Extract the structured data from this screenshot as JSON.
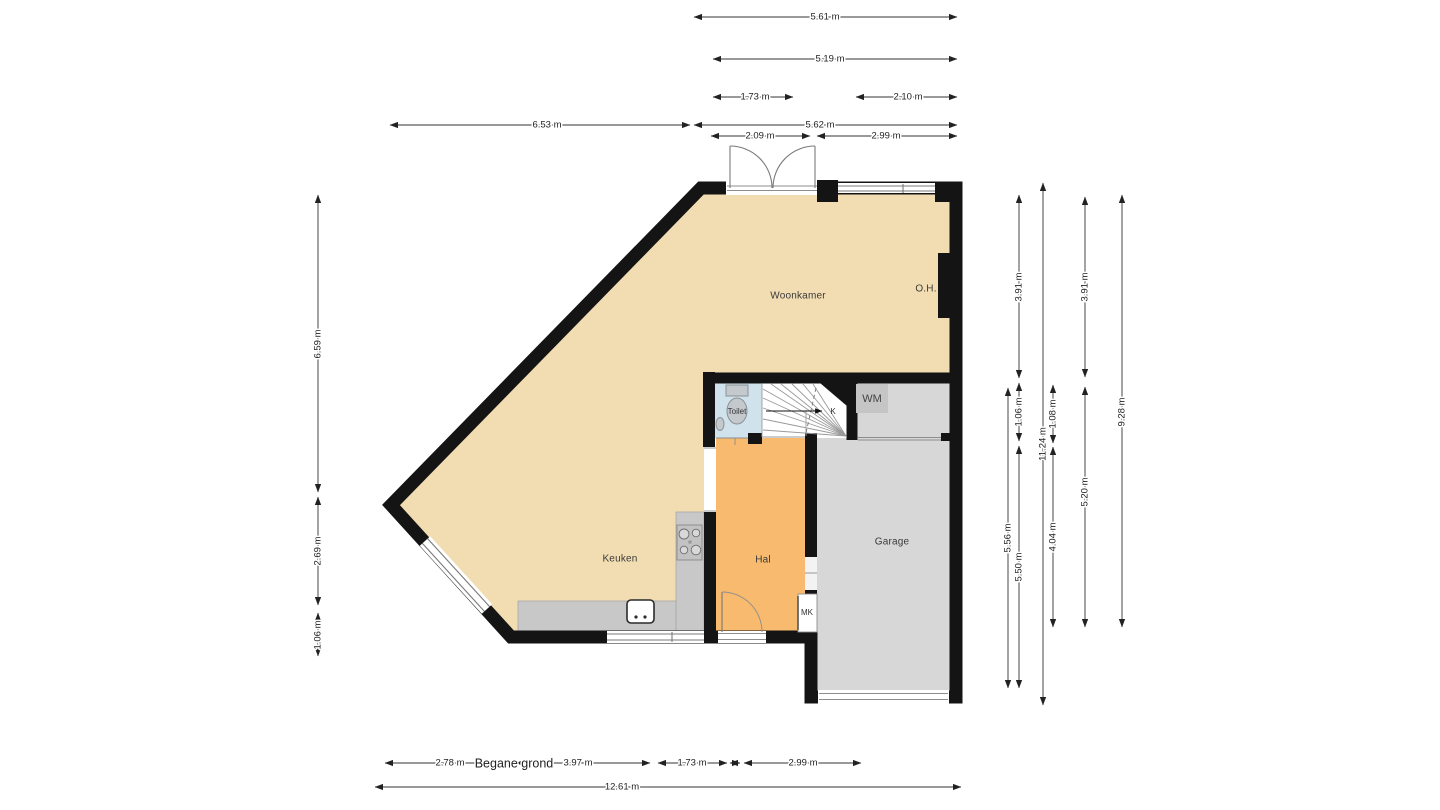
{
  "title": "Begane grond",
  "rooms": {
    "woonkamer": "Woonkamer",
    "keuken": "Keuken",
    "hal": "Hal",
    "garage": "Garage",
    "toilet": "Toilet",
    "stairs": "K",
    "fireplace": "O.H.",
    "washer": "WM",
    "meter_closet": "MK"
  },
  "dimensions": {
    "top": [
      "5.61 m",
      "5.19 m",
      "1.73 m",
      "2.10 m",
      "6.53 m",
      "5.62 m",
      "2.09 m",
      "2.99 m"
    ],
    "left": [
      "6.59 m",
      "2.69 m",
      "1.06 m"
    ],
    "right": [
      "3.91 m",
      "1.06 m",
      "5.50 m",
      "5.56 m",
      "11.24 m",
      "1.08 m",
      "4.04 m",
      "3.91 m",
      "5.20 m",
      "9.28 m"
    ],
    "bottom": [
      "2.78 m",
      "3.97 m",
      "1.73 m",
      "2.99 m",
      "12.61 m"
    ]
  },
  "colors": {
    "floor_living": "#f2dcb2",
    "floor_hall": "#f8ba6e",
    "floor_garage": "#d7d7d7",
    "floor_toilet": "#d0e2ec",
    "counter": "#c8c8c8",
    "wall": "#141414"
  }
}
